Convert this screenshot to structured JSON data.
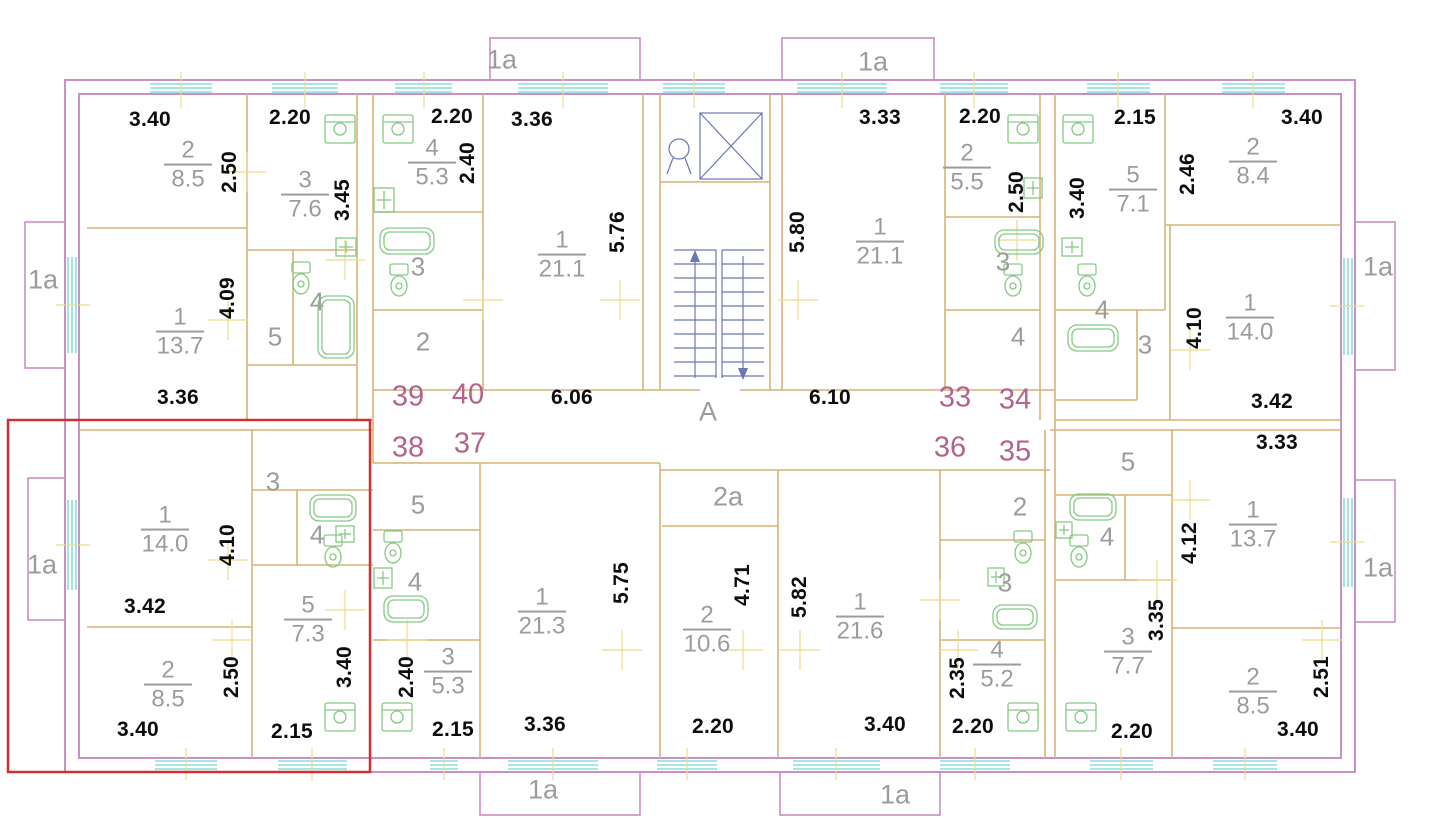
{
  "colors": {
    "wall_outline": "#c98fc9",
    "inner_wall": "#d7b277",
    "window": "#6fd6d6",
    "fixture": "#86c986",
    "stair": "#6b77b2",
    "tick": "#eedb8e",
    "highlight": "#d03030",
    "dimension_text": "#0d0d0d",
    "room_text": "#9c9c9c",
    "apartment_text": "#b4638c"
  },
  "dimensions": [
    {
      "text": "3.40",
      "x": 150,
      "y": 120,
      "vertical": false
    },
    {
      "text": "2.20",
      "x": 290,
      "y": 118,
      "vertical": false
    },
    {
      "text": "2.20",
      "x": 452,
      "y": 117,
      "vertical": false
    },
    {
      "text": "3.36",
      "x": 532,
      "y": 120,
      "vertical": false
    },
    {
      "text": "3.33",
      "x": 880,
      "y": 118,
      "vertical": false
    },
    {
      "text": "2.20",
      "x": 980,
      "y": 117,
      "vertical": false
    },
    {
      "text": "2.15",
      "x": 1135,
      "y": 118,
      "vertical": false
    },
    {
      "text": "3.40",
      "x": 1302,
      "y": 118,
      "vertical": false
    },
    {
      "text": "2.50",
      "x": 230,
      "y": 172,
      "vertical": true
    },
    {
      "text": "3.45",
      "x": 343,
      "y": 200,
      "vertical": true
    },
    {
      "text": "2.40",
      "x": 468,
      "y": 163,
      "vertical": true
    },
    {
      "text": "4.09",
      "x": 228,
      "y": 298,
      "vertical": true
    },
    {
      "text": "5.76",
      "x": 618,
      "y": 232,
      "vertical": true
    },
    {
      "text": "5.80",
      "x": 798,
      "y": 232,
      "vertical": true
    },
    {
      "text": "2.50",
      "x": 1017,
      "y": 192,
      "vertical": true
    },
    {
      "text": "3.40",
      "x": 1078,
      "y": 198,
      "vertical": true
    },
    {
      "text": "2.46",
      "x": 1188,
      "y": 174,
      "vertical": true
    },
    {
      "text": "4.10",
      "x": 1195,
      "y": 328,
      "vertical": true
    },
    {
      "text": "3.36",
      "x": 178,
      "y": 398,
      "vertical": false
    },
    {
      "text": "6.06",
      "x": 572,
      "y": 398,
      "vertical": false
    },
    {
      "text": "6.10",
      "x": 830,
      "y": 398,
      "vertical": false
    },
    {
      "text": "3.42",
      "x": 1272,
      "y": 402,
      "vertical": false
    },
    {
      "text": "3.42",
      "x": 145,
      "y": 607,
      "vertical": false
    },
    {
      "text": "3.33",
      "x": 1277,
      "y": 443,
      "vertical": false
    },
    {
      "text": "4.10",
      "x": 228,
      "y": 545,
      "vertical": true
    },
    {
      "text": "2.50",
      "x": 232,
      "y": 677,
      "vertical": true
    },
    {
      "text": "3.40",
      "x": 345,
      "y": 667,
      "vertical": true
    },
    {
      "text": "2.40",
      "x": 407,
      "y": 677,
      "vertical": true
    },
    {
      "text": "5.75",
      "x": 622,
      "y": 583,
      "vertical": true
    },
    {
      "text": "4.71",
      "x": 743,
      "y": 585,
      "vertical": true
    },
    {
      "text": "5.82",
      "x": 800,
      "y": 597,
      "vertical": true
    },
    {
      "text": "2.35",
      "x": 958,
      "y": 678,
      "vertical": true
    },
    {
      "text": "3.35",
      "x": 1157,
      "y": 620,
      "vertical": true
    },
    {
      "text": "4.12",
      "x": 1190,
      "y": 543,
      "vertical": true
    },
    {
      "text": "2.51",
      "x": 1322,
      "y": 677,
      "vertical": true
    },
    {
      "text": "3.40",
      "x": 138,
      "y": 730,
      "vertical": false
    },
    {
      "text": "2.15",
      "x": 292,
      "y": 732,
      "vertical": false
    },
    {
      "text": "2.15",
      "x": 453,
      "y": 730,
      "vertical": false
    },
    {
      "text": "3.36",
      "x": 545,
      "y": 725,
      "vertical": false
    },
    {
      "text": "2.20",
      "x": 713,
      "y": 727,
      "vertical": false
    },
    {
      "text": "3.40",
      "x": 885,
      "y": 725,
      "vertical": false
    },
    {
      "text": "2.20",
      "x": 973,
      "y": 727,
      "vertical": false
    },
    {
      "text": "2.20",
      "x": 1132,
      "y": 732,
      "vertical": false
    },
    {
      "text": "3.40",
      "x": 1298,
      "y": 730,
      "vertical": false
    }
  ],
  "rooms": [
    {
      "number": "2",
      "area": "8.5",
      "x": 188,
      "y": 165
    },
    {
      "number": "3",
      "area": "7.6",
      "x": 305,
      "y": 195
    },
    {
      "number": "1",
      "area": "13.7",
      "x": 180,
      "y": 332
    },
    {
      "number": "4",
      "area": "5.3",
      "x": 432,
      "y": 163
    },
    {
      "number": "1",
      "area": "21.1",
      "x": 562,
      "y": 255
    },
    {
      "number": "2",
      "area": "5.5",
      "x": 967,
      "y": 168
    },
    {
      "number": "1",
      "area": "21.1",
      "x": 880,
      "y": 242
    },
    {
      "number": "5",
      "area": "7.1",
      "x": 1133,
      "y": 190
    },
    {
      "number": "2",
      "area": "8.4",
      "x": 1253,
      "y": 162
    },
    {
      "number": "1",
      "area": "14.0",
      "x": 1250,
      "y": 318
    },
    {
      "number": "1",
      "area": "14.0",
      "x": 165,
      "y": 530
    },
    {
      "number": "5",
      "area": "7.3",
      "x": 308,
      "y": 620
    },
    {
      "number": "2",
      "area": "8.5",
      "x": 168,
      "y": 685
    },
    {
      "number": "3",
      "area": "5.3",
      "x": 448,
      "y": 672
    },
    {
      "number": "1",
      "area": "21.3",
      "x": 542,
      "y": 612
    },
    {
      "number": "2",
      "area": "10.6",
      "x": 707,
      "y": 630
    },
    {
      "number": "1",
      "area": "21.6",
      "x": 860,
      "y": 617
    },
    {
      "number": "4",
      "area": "5.2",
      "x": 997,
      "y": 665
    },
    {
      "number": "1",
      "area": "13.7",
      "x": 1253,
      "y": 525
    },
    {
      "number": "3",
      "area": "7.7",
      "x": 1128,
      "y": 652
    },
    {
      "number": "2",
      "area": "8.5",
      "x": 1253,
      "y": 692
    }
  ],
  "room_numbers": [
    {
      "text": "5",
      "x": 275,
      "y": 337
    },
    {
      "text": "4",
      "x": 317,
      "y": 302
    },
    {
      "text": "3",
      "x": 418,
      "y": 267
    },
    {
      "text": "2",
      "x": 423,
      "y": 342
    },
    {
      "text": "3",
      "x": 1003,
      "y": 262
    },
    {
      "text": "4",
      "x": 1018,
      "y": 337
    },
    {
      "text": "4",
      "x": 1102,
      "y": 310
    },
    {
      "text": "3",
      "x": 1145,
      "y": 345
    },
    {
      "text": "3",
      "x": 273,
      "y": 482
    },
    {
      "text": "4",
      "x": 317,
      "y": 535
    },
    {
      "text": "5",
      "x": 418,
      "y": 505
    },
    {
      "text": "4",
      "x": 415,
      "y": 582
    },
    {
      "text": "2",
      "x": 1020,
      "y": 507
    },
    {
      "text": "3",
      "x": 1005,
      "y": 583
    },
    {
      "text": "5",
      "x": 1128,
      "y": 462
    },
    {
      "text": "4",
      "x": 1107,
      "y": 537
    }
  ],
  "apartment_numbers": [
    {
      "text": "39",
      "x": 408,
      "y": 397
    },
    {
      "text": "40",
      "x": 468,
      "y": 395
    },
    {
      "text": "38",
      "x": 408,
      "y": 448
    },
    {
      "text": "37",
      "x": 470,
      "y": 444
    },
    {
      "text": "33",
      "x": 955,
      "y": 398
    },
    {
      "text": "34",
      "x": 1015,
      "y": 400
    },
    {
      "text": "36",
      "x": 950,
      "y": 448
    },
    {
      "text": "35",
      "x": 1015,
      "y": 452
    }
  ],
  "zone_labels": [
    {
      "text": "1a",
      "x": 502,
      "y": 60
    },
    {
      "text": "1a",
      "x": 873,
      "y": 62
    },
    {
      "text": "1a",
      "x": 43,
      "y": 280
    },
    {
      "text": "1a",
      "x": 42,
      "y": 565
    },
    {
      "text": "1a",
      "x": 1378,
      "y": 267
    },
    {
      "text": "1a",
      "x": 1378,
      "y": 568
    },
    {
      "text": "1a",
      "x": 543,
      "y": 790
    },
    {
      "text": "1a",
      "x": 895,
      "y": 795
    },
    {
      "text": "2a",
      "x": 728,
      "y": 497
    },
    {
      "text": "A",
      "x": 708,
      "y": 412
    }
  ]
}
